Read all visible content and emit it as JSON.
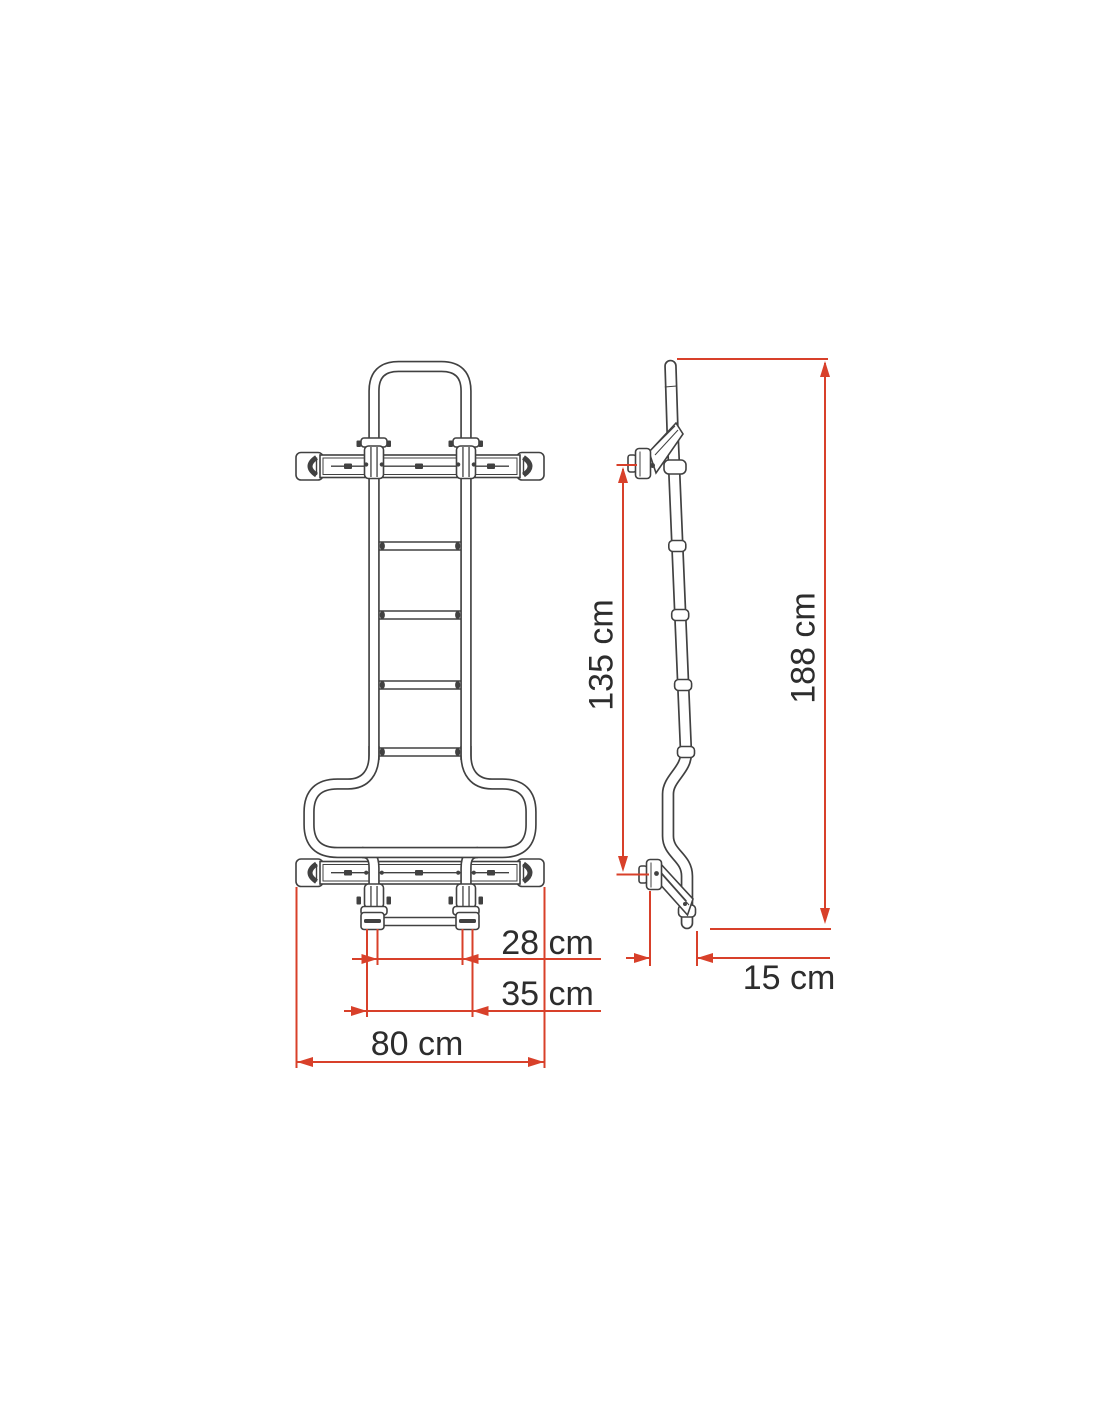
{
  "page": {
    "background": "#ffffff"
  },
  "diagram": {
    "subject": "rear-ladder-technical-drawing",
    "colors": {
      "outline": "#414141",
      "dimension_lines": "#d8402a",
      "label_text": "#2d2d2d",
      "background": "#ffffff"
    },
    "front_view": {
      "name": "front-view",
      "dimensions": {
        "inner_width": {
          "label": "28 cm"
        },
        "outer_width": {
          "label": "35 cm"
        },
        "bar_width": {
          "label": "80 cm"
        }
      }
    },
    "side_view": {
      "name": "side-view",
      "dimensions": {
        "bracket_span": {
          "label": "135 cm"
        },
        "total_height": {
          "label": "188 cm"
        },
        "standoff_depth": {
          "label": "15 cm"
        }
      }
    }
  }
}
